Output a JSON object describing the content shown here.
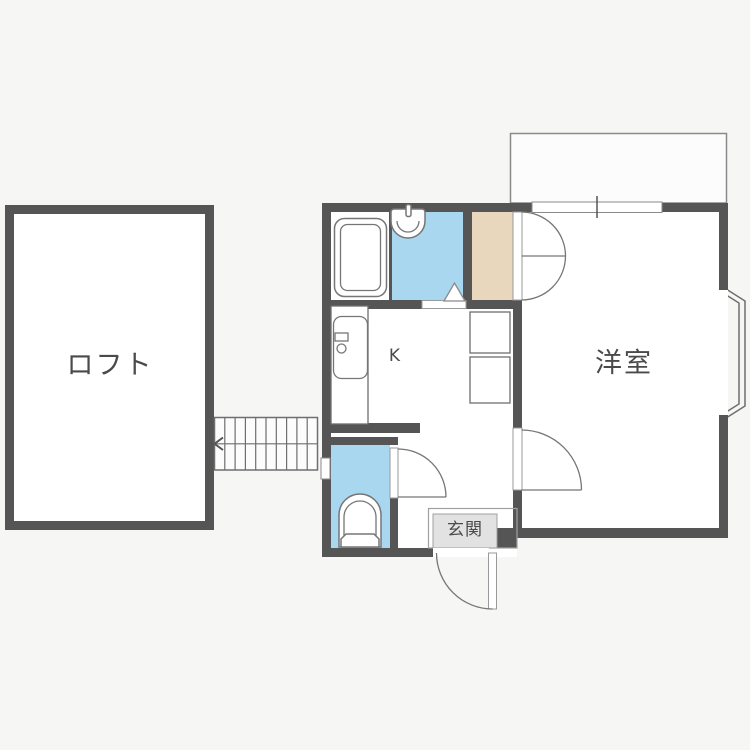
{
  "rooms": {
    "loft": {
      "label": "ロフト"
    },
    "western_room": {
      "label": "洋室"
    },
    "kitchen": {
      "label": "K"
    },
    "entrance": {
      "label": "玄関"
    }
  },
  "fixtures": [
    "bathtub",
    "wash-basin",
    "kitchen-sink",
    "toilet",
    "storage-squares",
    "stairs-with-arrow",
    "closet-double-door",
    "western-room-door",
    "toilet-door",
    "entrance-door",
    "bath-door-triangle",
    "window",
    "toilet-window",
    "bay-window",
    "balcony"
  ],
  "colors": {
    "wall": "#555555",
    "water": "#a9d7f0",
    "closet": "#e8d7bc",
    "genkan": "#e2e2e2",
    "line": "#767676",
    "bg": "#f6f6f5",
    "room": "#ffffff",
    "text": "#4a4a4a",
    "outdoor": "#fcfcfc"
  }
}
